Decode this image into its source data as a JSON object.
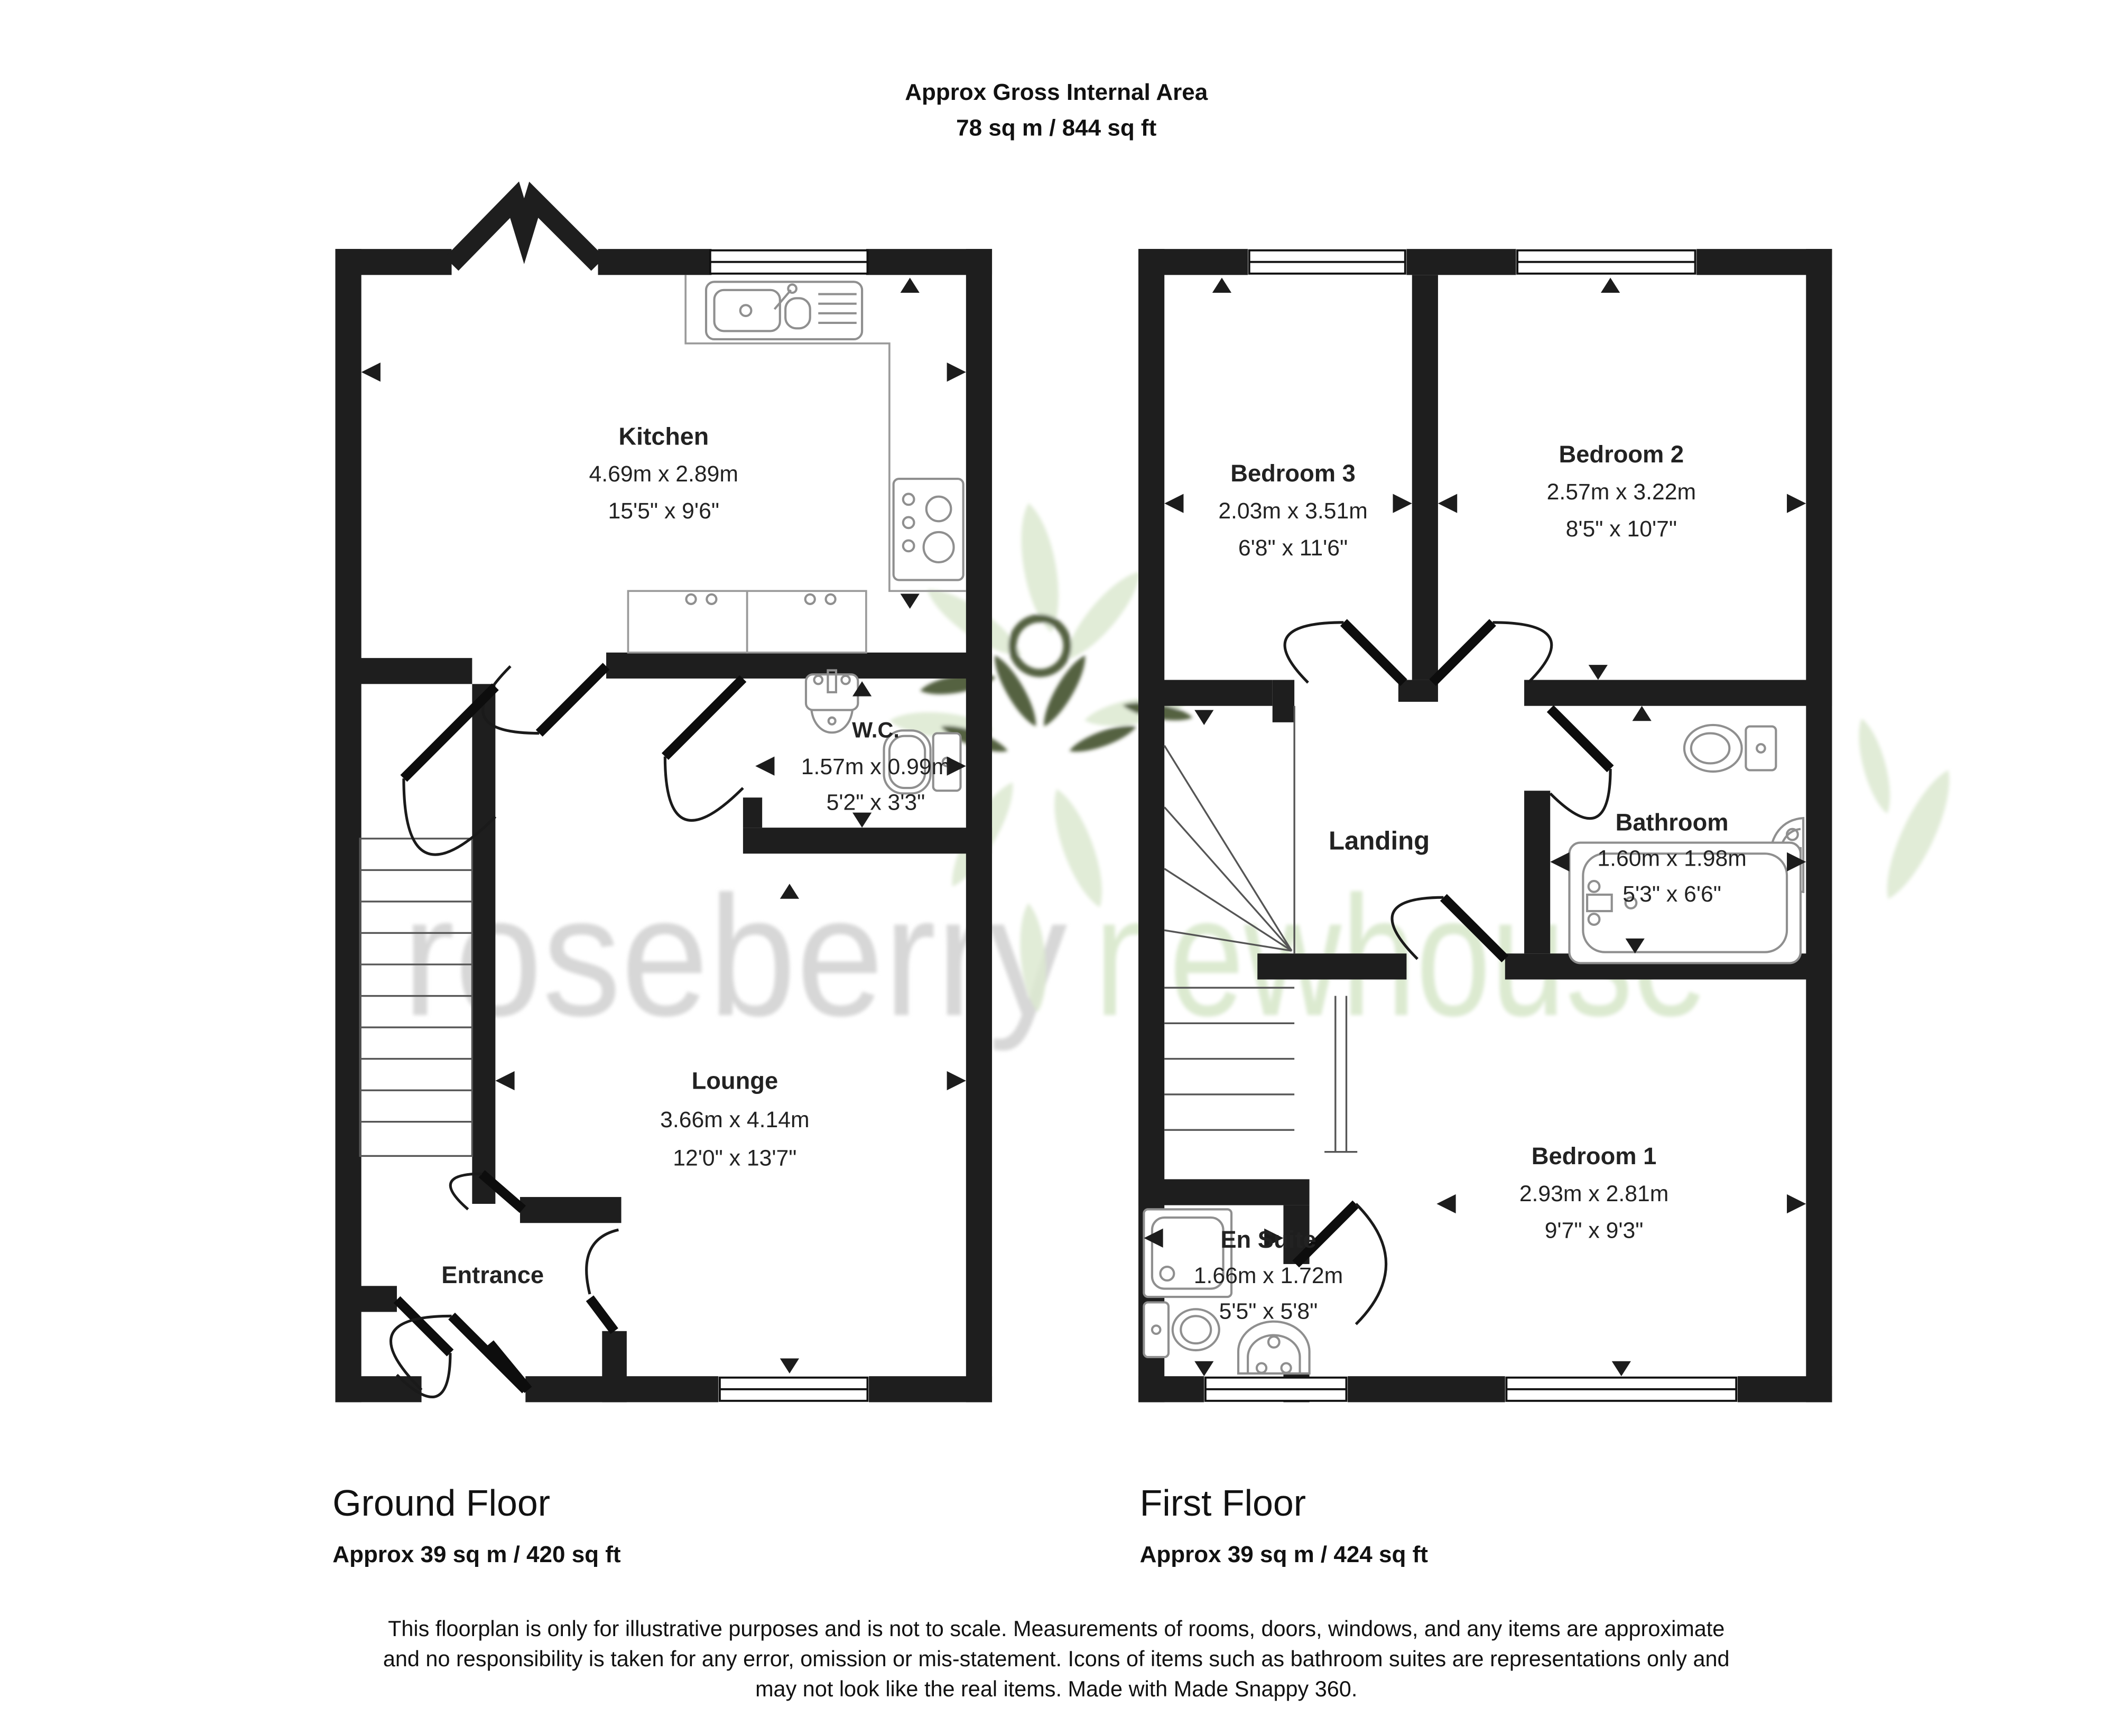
{
  "header": {
    "title": "Approx Gross Internal Area",
    "subtitle": "78 sq m / 844 sq ft"
  },
  "watermark": {
    "word1": "roseberry",
    "word2": "newhouse",
    "word1_color": "#d7d7d7",
    "word2_color": "#dcead0",
    "logo_light_green": "#dce9d0",
    "logo_dark_green": "#36451f"
  },
  "ground_floor": {
    "floor_label": "Ground Floor",
    "floor_area": "Approx 39 sq m / 420 sq ft",
    "rooms": {
      "kitchen": {
        "name": "Kitchen",
        "metric": "4.69m x 2.89m",
        "imperial": "15'5\" x 9'6\""
      },
      "wc": {
        "name": "W.C.",
        "metric": "1.57m x 0.99m",
        "imperial": "5'2\" x 3'3\""
      },
      "lounge": {
        "name": "Lounge",
        "metric": "3.66m x 4.14m",
        "imperial": "12'0\" x 13'7\""
      },
      "entrance": {
        "name": "Entrance"
      }
    }
  },
  "first_floor": {
    "floor_label": "First Floor",
    "floor_area": "Approx 39 sq m / 424 sq ft",
    "rooms": {
      "bedroom3": {
        "name": "Bedroom 3",
        "metric": "2.03m x 3.51m",
        "imperial": "6'8\" x 11'6\""
      },
      "bedroom2": {
        "name": "Bedroom 2",
        "metric": "2.57m x 3.22m",
        "imperial": "8'5\" x 10'7\""
      },
      "landing": {
        "name": "Landing"
      },
      "bathroom": {
        "name": "Bathroom",
        "metric": "1.60m x 1.98m",
        "imperial": "5'3\" x 6'6\""
      },
      "ensuite": {
        "name": "En Suite",
        "metric": "1.66m x 1.72m",
        "imperial": "5'5\" x 5'8\""
      },
      "bedroom1": {
        "name": "Bedroom 1",
        "metric": "2.93m x 2.81m",
        "imperial": "9'7\" x 9'3\""
      }
    }
  },
  "footer": {
    "disclaimer_line1": "This floorplan is only for illustrative purposes and is not to scale. Measurements of rooms, doors, windows, and any items are approximate",
    "disclaimer_line2": "and no responsibility is taken for any error, omission or mis-statement. Icons of items such as bathroom suites are representations only and",
    "disclaimer_line3": "may not look like the real items. Made with Made Snappy 360."
  },
  "colors": {
    "wall": "#1e1e1e",
    "background": "#ffffff"
  }
}
